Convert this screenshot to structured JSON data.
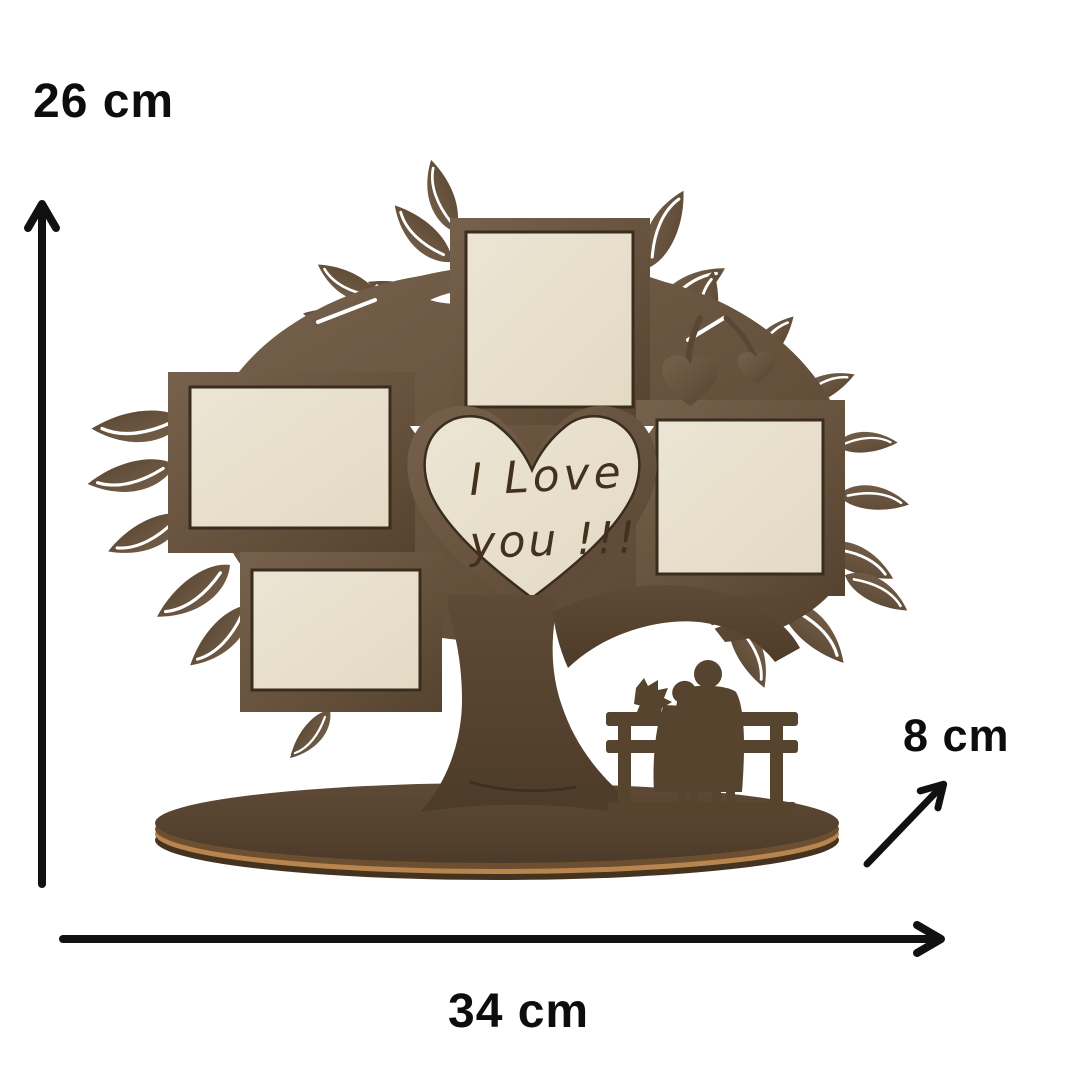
{
  "annotations": {
    "height_label": "26 cm",
    "width_label": "34 cm",
    "depth_label": "8 cm"
  },
  "product": {
    "heart_text_line1": "I Love",
    "heart_text_line2": "you !!!",
    "photo_slots": 4
  },
  "colors": {
    "wood": "#66523d",
    "wood_light": "#75614c",
    "wood_dark": "#533f2c",
    "insert_cream": "#e8e0cd",
    "base_edge_light": "#b9854f",
    "base_edge_dark": "#43331f",
    "engraving": "#43311d",
    "annotation_black": "#111111",
    "background": "#ffffff"
  }
}
